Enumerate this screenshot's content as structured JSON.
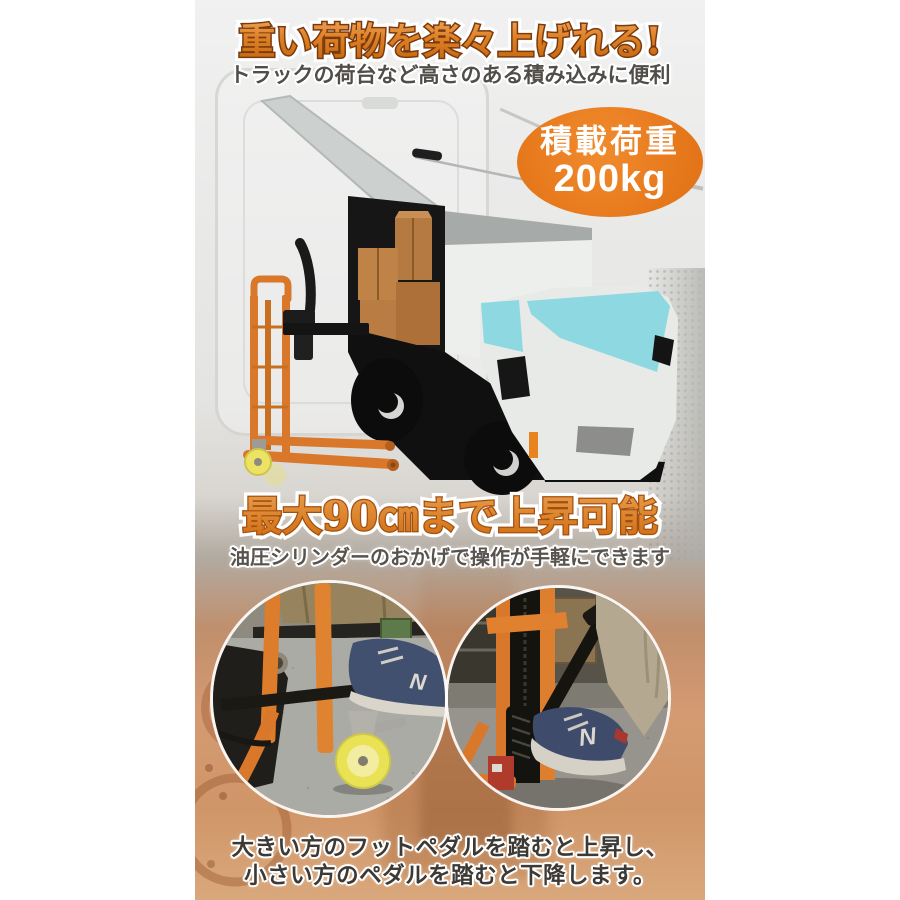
{
  "hero": {
    "title": "重い荷物を楽々上げれる!",
    "subtitle": "トラックの荷台など高さのある積み込みに便利"
  },
  "badge": {
    "line1": "積載荷重",
    "line2": "200kg",
    "color": "#e8791c"
  },
  "lift": {
    "title": "最大90㎝まで上昇可能",
    "subtitle": "油圧シリンダーのおかげで操作が手軽にできます"
  },
  "footer": {
    "line1": "大きい方のフットペダルを踏むと上昇し、",
    "line2": "小さい方のペダルを踏むと下降します。"
  },
  "photos": {
    "left": {
      "shoe_logo": "N"
    },
    "right": {
      "shoe_logo": "N"
    }
  },
  "colors": {
    "accent_orange": "#e8791c",
    "heading_orange": "#d97a20",
    "stacker_orange": "#d9782b",
    "windshield_cyan": "#8ed8e1"
  }
}
